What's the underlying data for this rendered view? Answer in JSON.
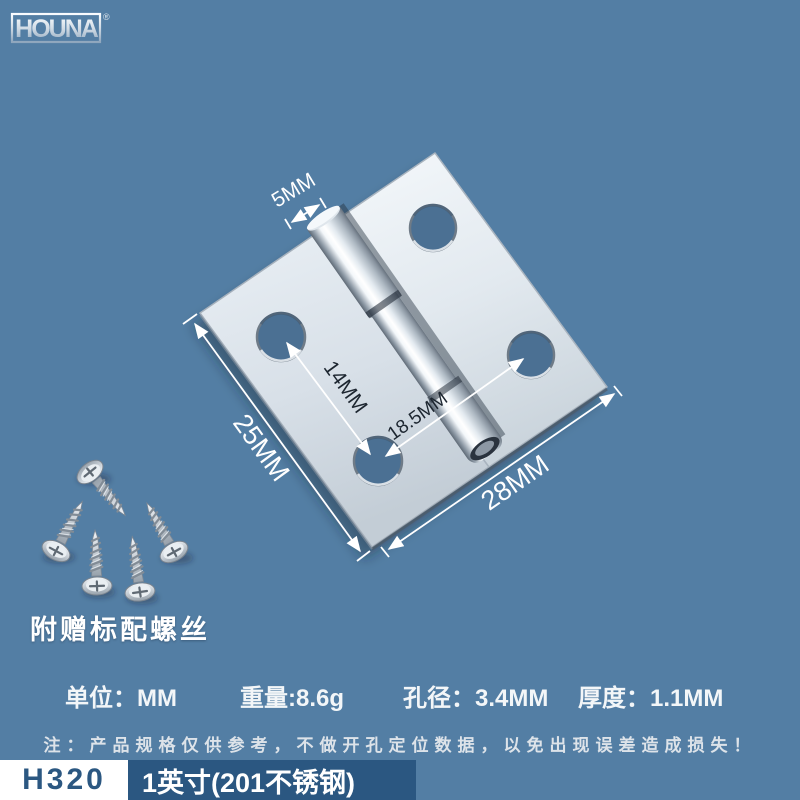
{
  "brand": {
    "name": "HOUNA",
    "registered": "®"
  },
  "hinge_diagram": {
    "dim_pin_width": "5MM",
    "dim_hole_pitch": "14MM",
    "dim_cross_pitch": "18.5MM",
    "dim_height": "25MM",
    "dim_width": "28MM",
    "screws_caption": "附赠标配螺丝"
  },
  "specs": {
    "unit": "单位：MM",
    "weight": "重量:8.6g",
    "hole_diameter": "孔径：3.4MM",
    "thickness": "厚度：1.1MM"
  },
  "note": "注：产品规格仅供参考，不做开孔定位数据，以免出现误差造成损失！",
  "footer": {
    "model": "H320",
    "spec_label": "1英寸(201不锈钢)"
  },
  "colors": {
    "background": "#537ea4",
    "accent_bar": "#2b5781",
    "metal_light": "#eef2f6",
    "metal_dark": "#6d7884",
    "dim_line": "#ffffff",
    "dim_text_dark": "#1d2630"
  }
}
